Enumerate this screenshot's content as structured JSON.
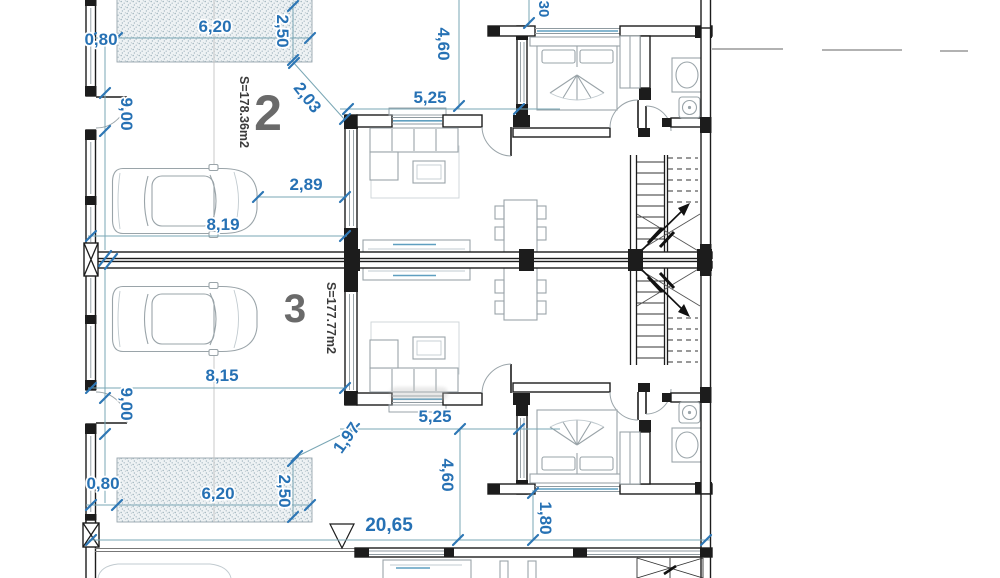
{
  "plan": {
    "units": [
      {
        "number": "2",
        "area_label": "S=178.36m2"
      },
      {
        "number": "3",
        "area_label": "S=177.77m2"
      }
    ],
    "dims": {
      "top_setback": "0,80",
      "top_porch_width": "6,20",
      "top_porch_depth": "2,50",
      "top_entry_diagonal": "2,03",
      "top_patio_depth": "4,60",
      "top_living_width": "5,25",
      "top_cut_dim": "30",
      "top_side_door": "9,00",
      "garage_clearance": "2,89",
      "garage_depth_unit2": "8,19",
      "garage_depth_unit3": "8,15",
      "bottom_side_door": "9,00",
      "bottom_entry_diagonal": "1,97",
      "bottom_setback": "0,80",
      "bottom_porch_width": "6,20",
      "bottom_porch_depth": "2,50",
      "bottom_living_width": "5,25",
      "bottom_patio_depth": "4,60",
      "total_width": "20,65",
      "rear_strip": "1,80"
    },
    "colors": {
      "dimension_text": "#2671b4",
      "dimension_line": "#7aa7b5",
      "wall": "#1c1c1c",
      "furniture": "#9aa4a9",
      "accent": "#5f9fc0",
      "unit_number": "#6a6a6a"
    }
  }
}
